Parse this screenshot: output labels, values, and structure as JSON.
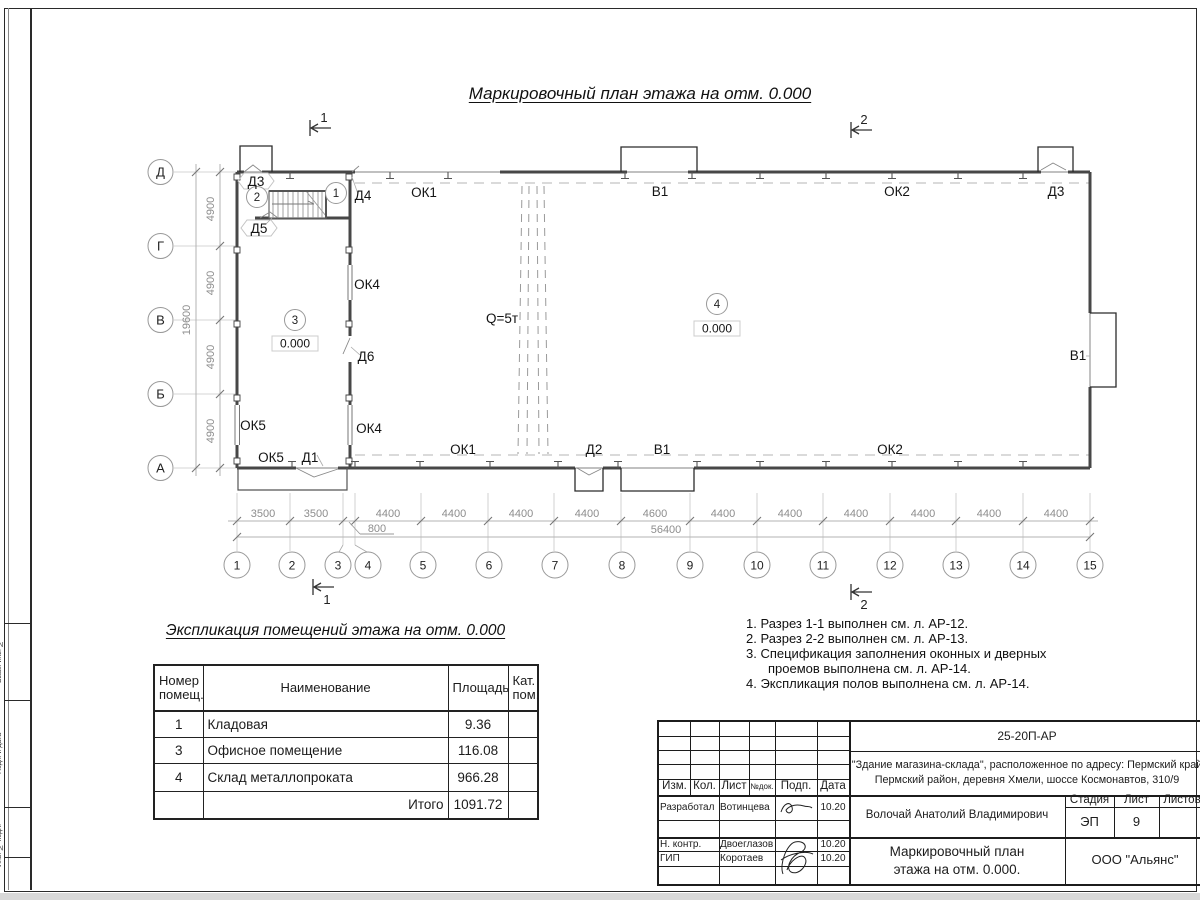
{
  "sheet": {
    "title": "Маркировочный план этажа на отм. 0.000",
    "frame_labels": [
      "Взам. инв. №",
      "Подп. и дата",
      "Инв. № подл."
    ]
  },
  "plan": {
    "row_axes": [
      "Д",
      "Г",
      "В",
      "Б",
      "А"
    ],
    "columns": [
      "1",
      "2",
      "3",
      "4",
      "5",
      "6",
      "7",
      "8",
      "9",
      "10",
      "11",
      "12",
      "13",
      "14",
      "15"
    ],
    "dims_bottom": [
      "3500",
      "3500",
      "800",
      "4400",
      "4400",
      "4400",
      "4400",
      "4600",
      "4400",
      "4400",
      "4400",
      "4400",
      "4400",
      "4400"
    ],
    "dim_total_bottom": "56400",
    "dims_left": [
      "4900",
      "4900",
      "4900",
      "4900"
    ],
    "dim_total_left": "19600",
    "sections": {
      "one": "1",
      "two": "2"
    },
    "labels": {
      "d1": "Д1",
      "d2": "Д2",
      "d3_tl": "Д3",
      "d3_tr": "Д3",
      "d4": "Д4",
      "d5": "Д5",
      "d6": "Д6",
      "ok1_top": "ОК1",
      "ok1_bot": "ОК1",
      "ok2_top": "ОК2",
      "ok2_bot": "ОК2",
      "ok4_top": "ОК4",
      "ok4_bot": "ОК4",
      "ok5_left": "ОК5",
      "ok5_bot": "ОК5",
      "v1_top": "В1",
      "v1_right": "В1",
      "v1_bot": "В1",
      "crane": "Q=5т",
      "elevation": "0.000",
      "room1": "1",
      "room2": "2",
      "room3": "3",
      "room4": "4"
    }
  },
  "explication": {
    "title": "Экспликация помещений этажа на отм. 0.000",
    "headers": {
      "num": "Номер помещ.",
      "name": "Наименование",
      "area": "Площадь",
      "cat": "Кат. пом."
    },
    "rows": [
      {
        "num": "1",
        "name": "Кладовая",
        "area": "9.36",
        "cat": ""
      },
      {
        "num": "3",
        "name": "Офисное помещение",
        "area": "116.08",
        "cat": ""
      },
      {
        "num": "4",
        "name": "Склад металлопроката",
        "area": "966.28",
        "cat": ""
      }
    ],
    "total_label": "Итого",
    "total_value": "1091.72"
  },
  "notes": [
    "1. Разрез 1-1 выполнен см. л. АР-12.",
    "2. Разрез 2-2 выполнен см. л. АР-13.",
    "3. Спецификация заполнения оконных и дверных проемов выполнена см. л. АР-14.",
    "4. Экспликация полов выполнена см. л. АР-14."
  ],
  "titleblock": {
    "doc_number": "25-20П-АР",
    "project_line1": "\"Здание магазина-склада\", расположенное по адресу: Пермский край",
    "project_line2": "Пермский район, деревня Хмели, шоссе Космонавтов, 310/9",
    "cols": {
      "izm": "Изм.",
      "kol": "Кол.",
      "list": "Лист",
      "ndok": "№док.",
      "podp": "Подп.",
      "data": "Дата"
    },
    "staff": [
      {
        "role": "Разработал",
        "name": "Вотинцева",
        "date": "10.20"
      },
      {
        "role": "Н. контр.",
        "name": "Двоеглазов",
        "date": "10.20"
      },
      {
        "role": "ГИП",
        "name": "Коротаев",
        "date": "10.20"
      }
    ],
    "chief": "Волочай Анатолий Владимирович",
    "stage_label": "Стадия",
    "sheet_label": "Лист",
    "sheets_label": "Листов",
    "stage": "ЭП",
    "sheet_num": "9",
    "sheets_total": "",
    "drawing_title_line1": "Маркировочный план",
    "drawing_title_line2": "этажа на отм. 0.000.",
    "company": "ООО \"Альянс\""
  }
}
